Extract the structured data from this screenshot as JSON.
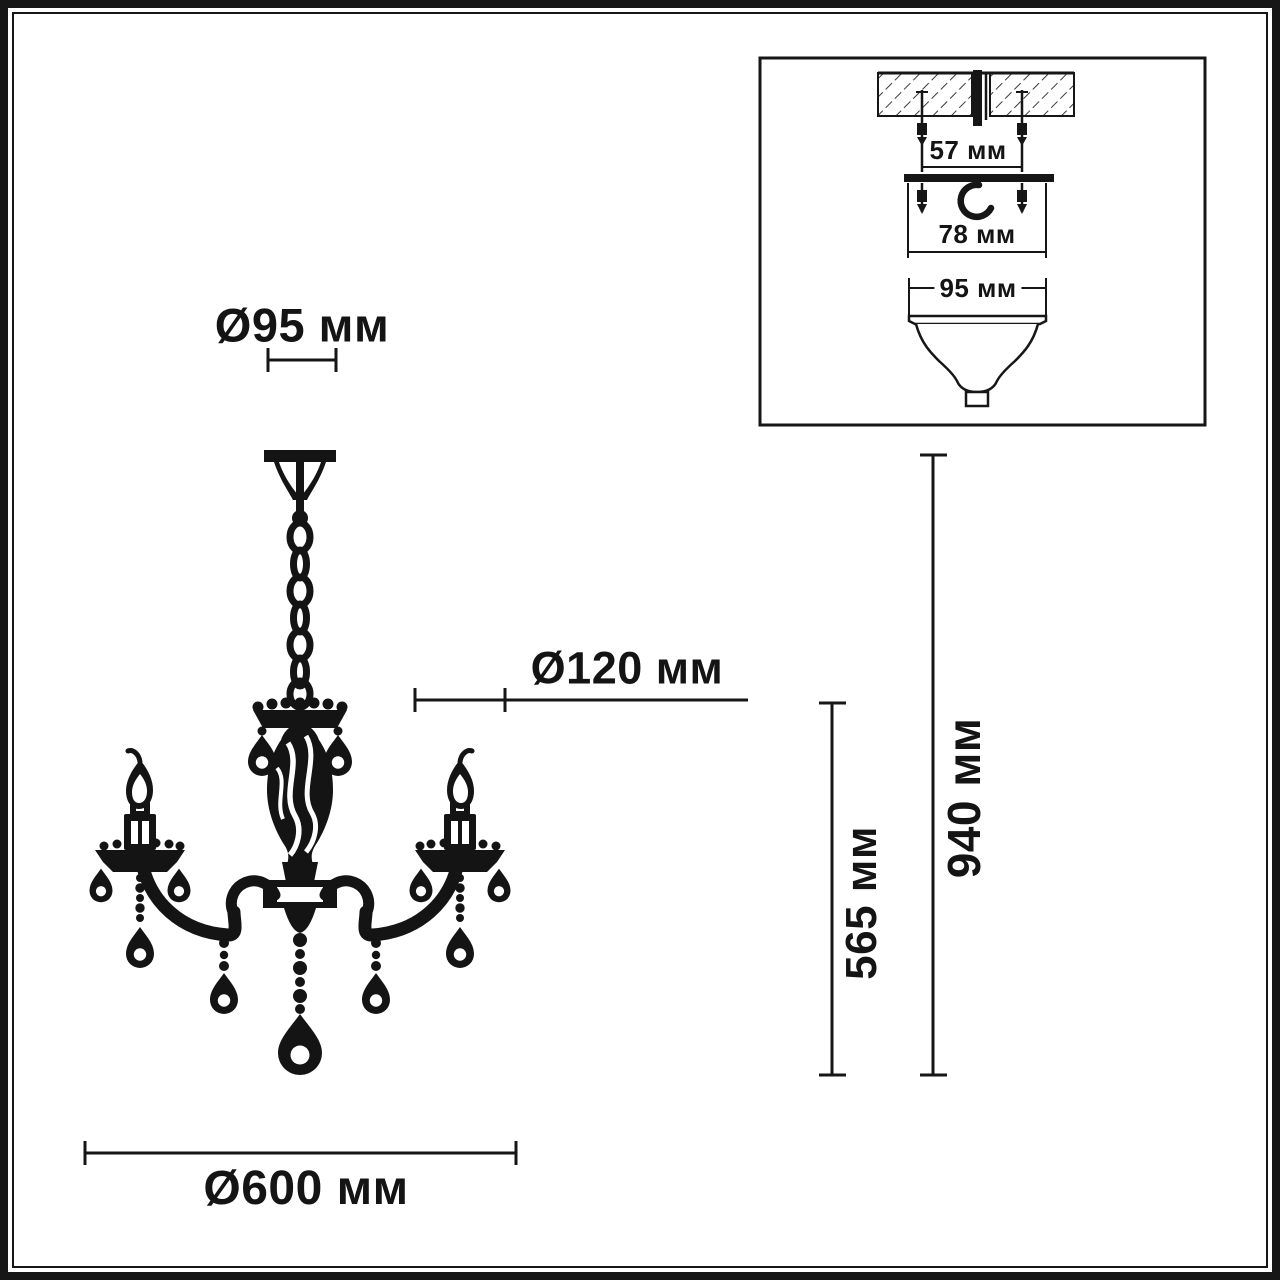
{
  "dimensions": {
    "canopy_diameter": "Ø95 мм",
    "column_diameter": "Ø120 мм",
    "fixture_diameter": "Ø600 мм",
    "body_height": "565 мм",
    "total_height": "940 мм"
  },
  "mounting_inset": {
    "anchor_spacing": "57 мм",
    "bracket_width": "78 мм",
    "canopy_width": "95 мм"
  },
  "colors": {
    "ink": "#161616",
    "background": "#ffffff"
  }
}
